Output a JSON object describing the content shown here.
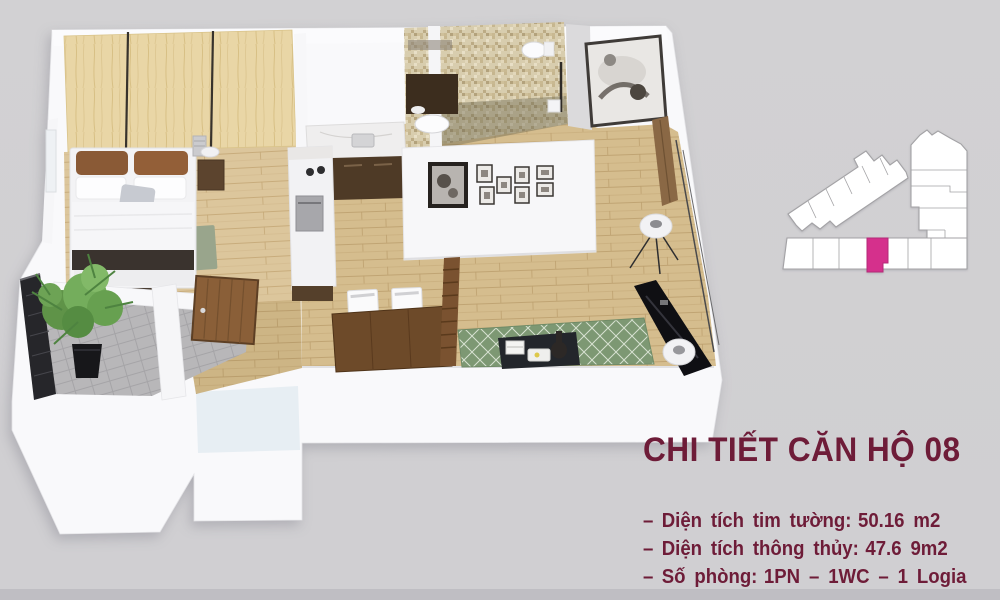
{
  "page": {
    "title": "CHI TIẾT CĂN HỘ 08",
    "details": [
      {
        "bullet": "–",
        "label": "Diện tích tim tường:",
        "value": "50.16 m2"
      },
      {
        "bullet": "–",
        "label": "Diện tích thông thủy:",
        "value": "47.6 9m2"
      },
      {
        "bullet": "–",
        "label": "Số phòng:",
        "value": "1PN – 1WC – 1 Logia"
      }
    ]
  },
  "palette": {
    "background": "#d2d1d3",
    "footer-strip": "#bfbec3",
    "text-maroon": "#6e1c38",
    "unit-highlight": "#d5308c",
    "plan-white": "#f9f9fb",
    "wood-floor": "#d5bd8e",
    "rug-green": "#7d9873",
    "balcony-tile": "#b8b7b9"
  }
}
